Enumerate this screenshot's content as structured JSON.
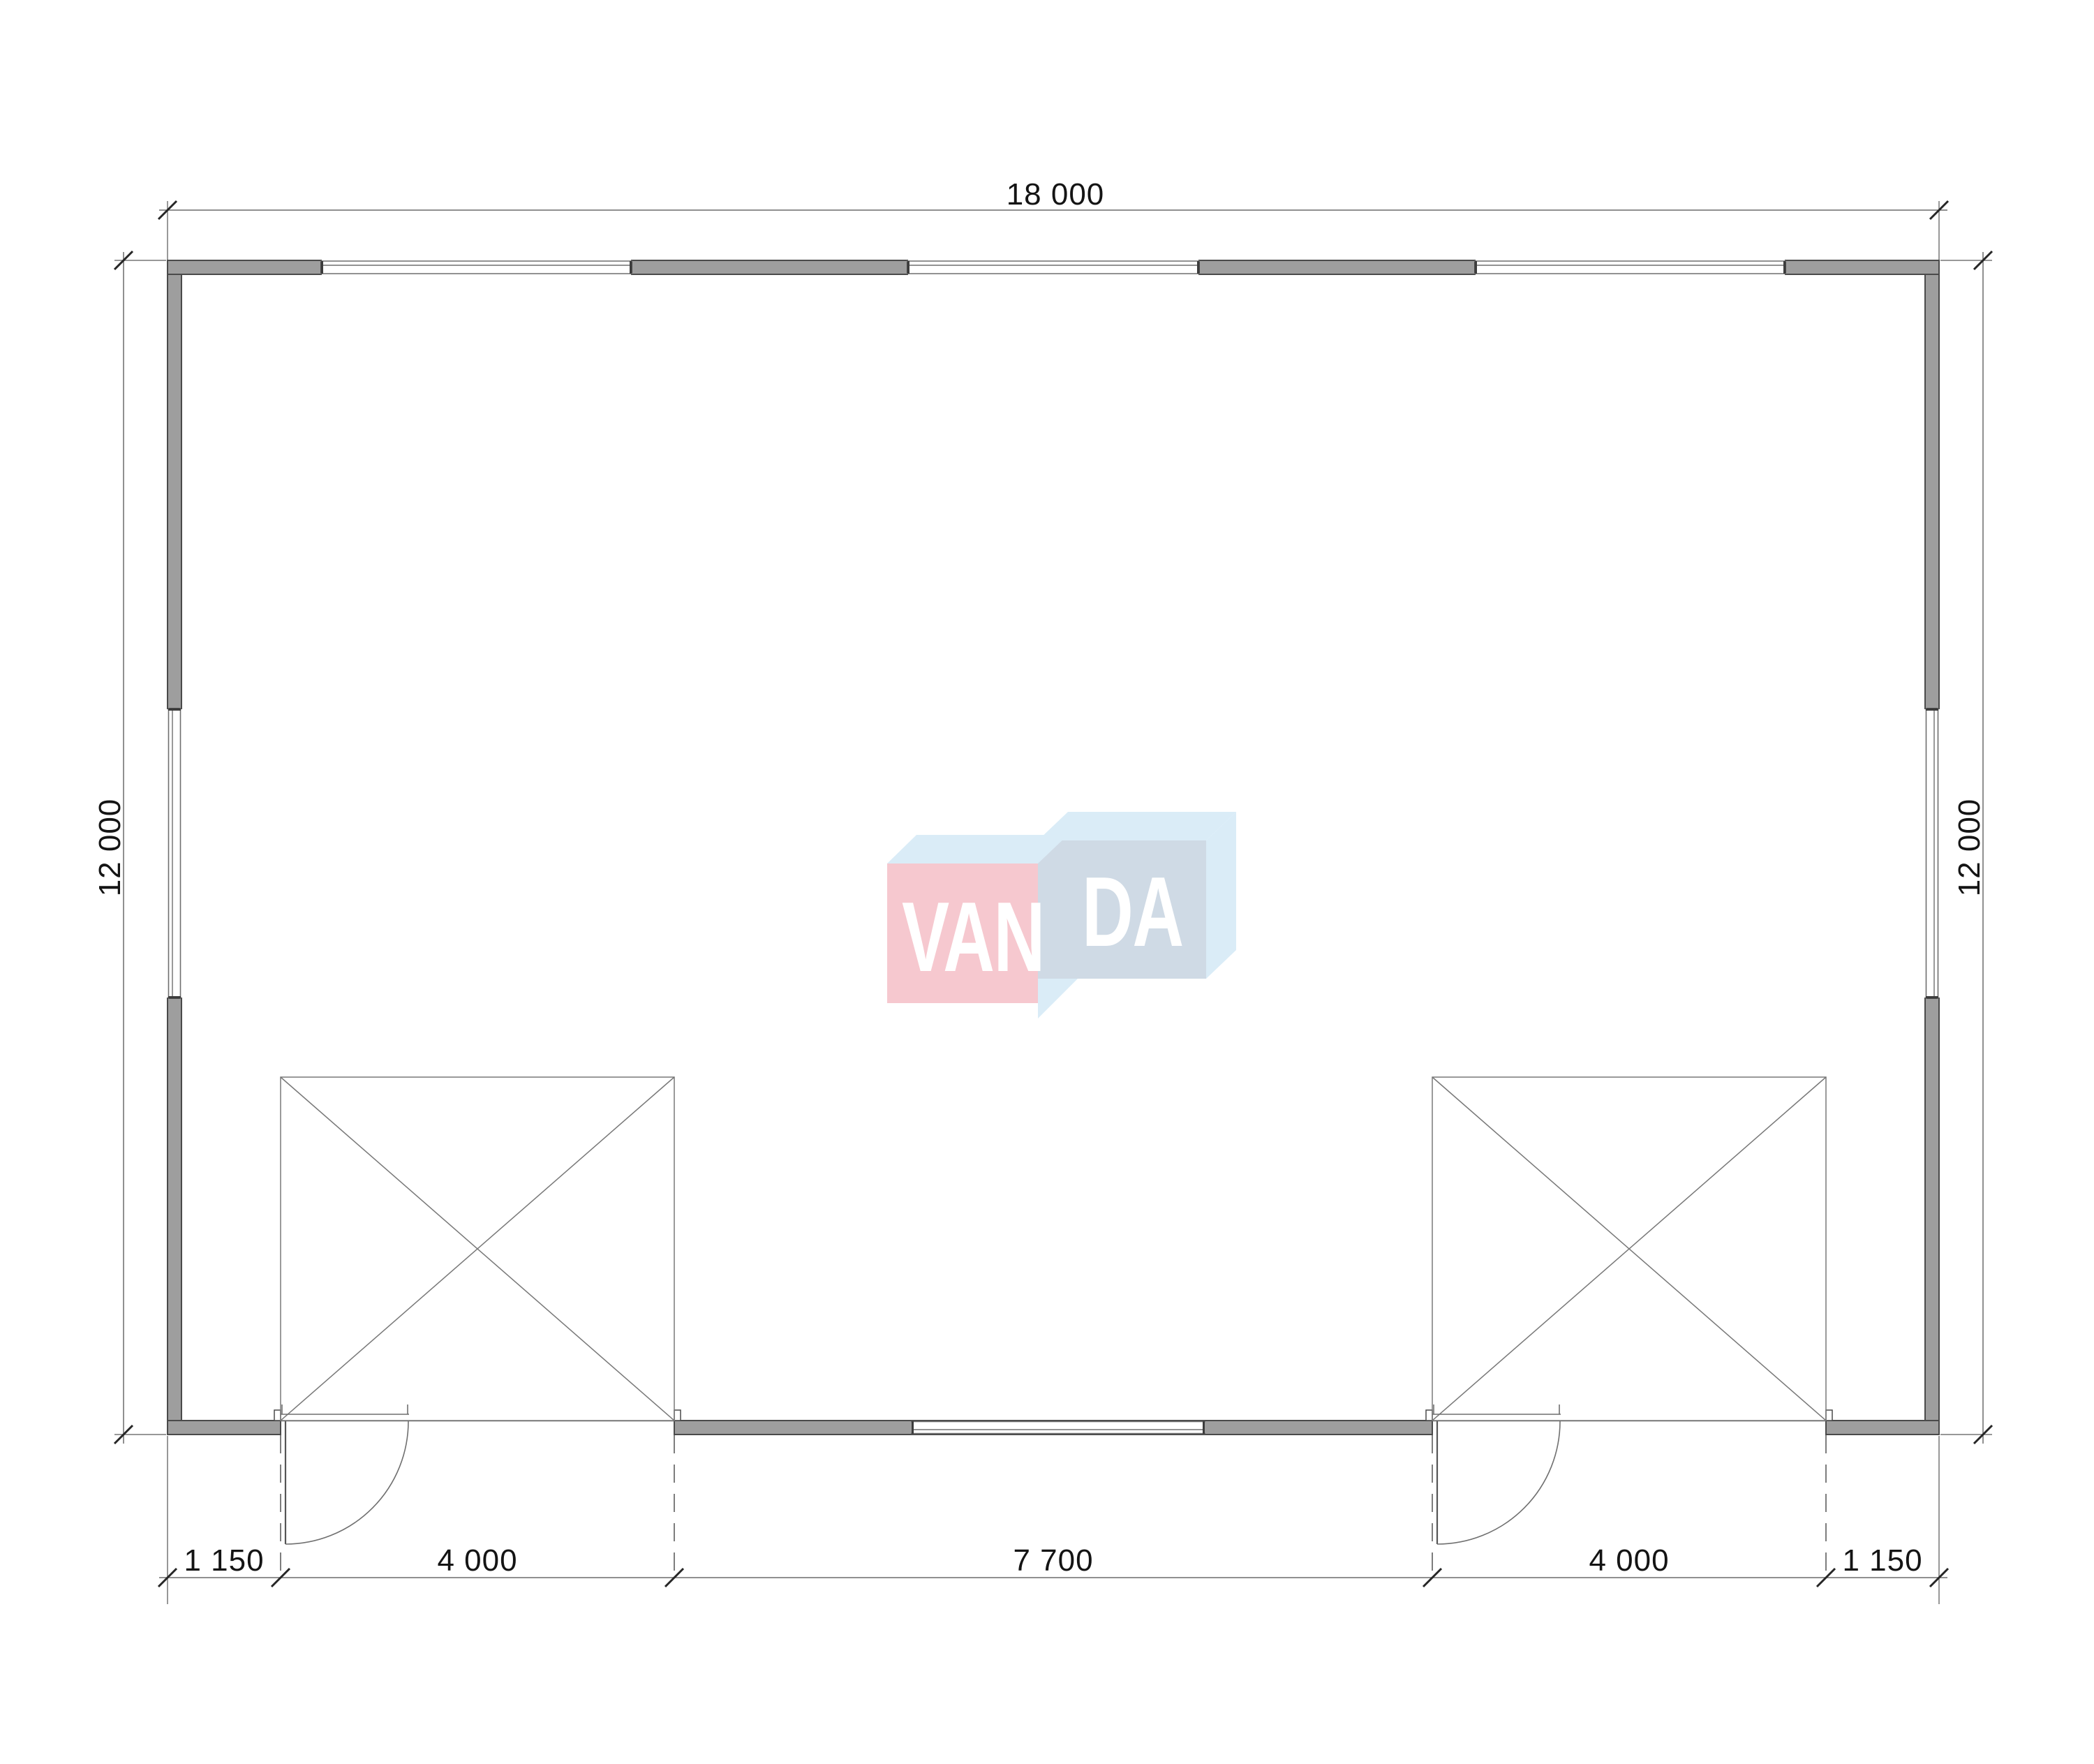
{
  "plan": {
    "title": "floor-plan",
    "wall_fill_color": "#9e9e9e",
    "line_color": "#4a4a4a",
    "building": {
      "overall_width_mm": "18 000",
      "overall_depth_mm": "12 000",
      "window_count": 5,
      "garage_opening_count": 2,
      "swing_door_count": 2
    }
  },
  "dimensions": {
    "top_width": "18 000",
    "left_height": "12 000",
    "right_height": "12 000",
    "bottom_segments": [
      "1 150",
      "4 000",
      "7 700",
      "4 000",
      "1 150"
    ]
  },
  "watermark": {
    "brand": "VANDA",
    "text_left": "VAN",
    "text_right": "DA",
    "colors": {
      "pink_box": "#f6c4cb",
      "blue_box": "#ccd7e3",
      "light_blue": "#d7ebf7",
      "letters": "#ffffff"
    }
  }
}
